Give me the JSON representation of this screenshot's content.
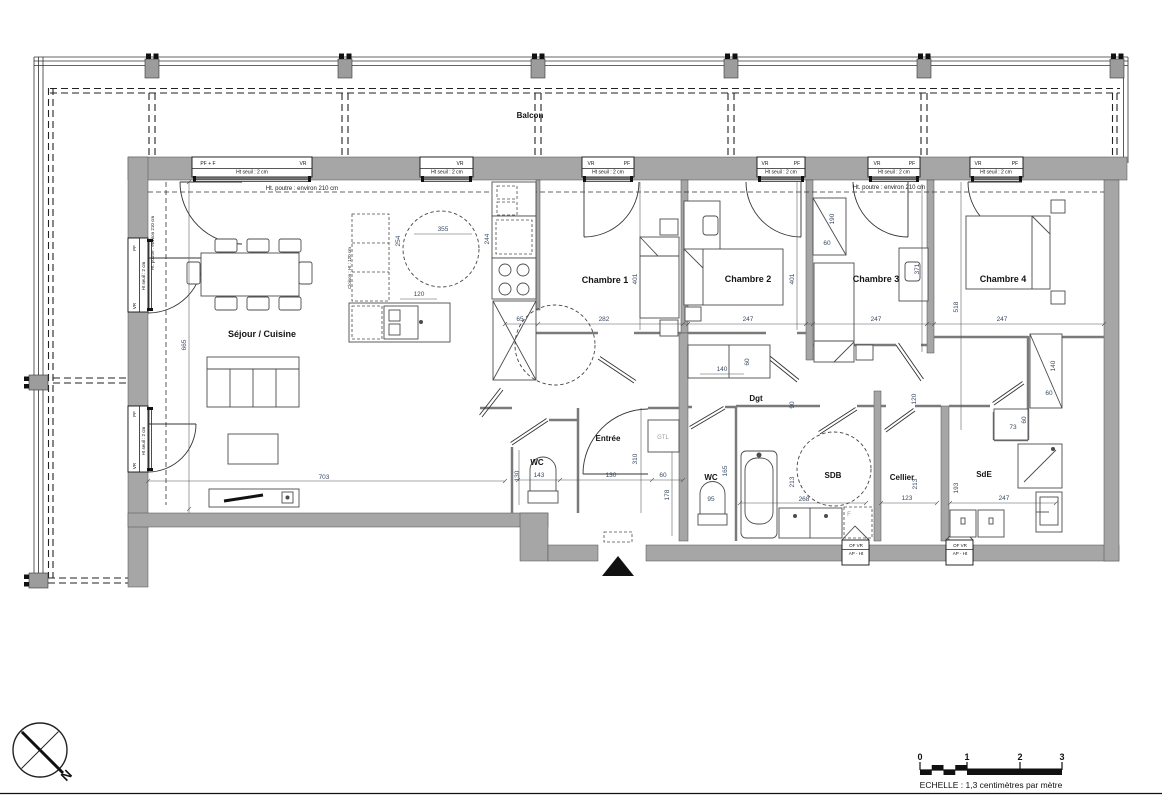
{
  "drawing": {
    "kind": "apartment floor plan",
    "compass": {
      "label": "N"
    },
    "scalebar": {
      "caption": "ECHELLE : 1,3 centimètres par mètre",
      "ticks": [
        {
          "t": "0",
          "x": 920,
          "y": 760
        },
        {
          "t": "1",
          "x": 967,
          "y": 760
        },
        {
          "t": "2",
          "x": 1020,
          "y": 760
        },
        {
          "t": "3",
          "x": 1062,
          "y": 760
        }
      ]
    }
  },
  "rooms": [
    {
      "t": "Séjour / Cuisine",
      "x": 262,
      "y": 337
    },
    {
      "t": "Chambre 1",
      "x": 605,
      "y": 283
    },
    {
      "t": "Chambre 2",
      "x": 748,
      "y": 282
    },
    {
      "t": "Chambre 3",
      "x": 876,
      "y": 282
    },
    {
      "t": "Chambre 4",
      "x": 1003,
      "y": 282
    },
    {
      "t": "Dgt",
      "x": 756,
      "y": 401,
      "c": "balcon"
    },
    {
      "t": "Entrée",
      "x": 608,
      "y": 441,
      "c": "balcon"
    },
    {
      "t": "WC",
      "x": 537,
      "y": 465,
      "c": "balcon"
    },
    {
      "t": "WC",
      "x": 711,
      "y": 480,
      "c": "balcon"
    },
    {
      "t": "SDB",
      "x": 833,
      "y": 478,
      "c": "balcon"
    },
    {
      "t": "Cellier",
      "x": 902,
      "y": 480,
      "c": "balcon"
    },
    {
      "t": "SdE",
      "x": 984,
      "y": 477,
      "c": "balcon"
    },
    {
      "t": "Balcon",
      "x": 530,
      "y": 118,
      "c": "balcon"
    }
  ],
  "annotations": [
    {
      "t": "Ht. poutre : environ 210 cm",
      "x": 302,
      "y": 190
    },
    {
      "t": "Ht. poutre : environ 210 cm",
      "x": 889,
      "y": 189
    },
    {
      "t": "Ht. poutre : environ 210 cm",
      "x": 154,
      "y": 243,
      "r": -90,
      "c": "tiny"
    },
    {
      "t": "Cloison : Ht : 120 cm",
      "x": 351,
      "y": 268,
      "r": -90,
      "c": "tiny"
    },
    {
      "t": "GTL",
      "x": 663,
      "y": 439,
      "c": "muted"
    },
    {
      "t": "F",
      "x": 849,
      "y": 516,
      "c": "muted"
    }
  ],
  "window_labels": [
    {
      "t": "PF + F",
      "x": 208,
      "y": 165
    },
    {
      "t": "VR",
      "x": 303,
      "y": 165
    },
    {
      "t": "Ht seuil : 2 cm",
      "x": 252,
      "y": 173.5
    },
    {
      "t": "VR",
      "x": 460,
      "y": 165
    },
    {
      "t": "Ht seuil : 2 cm",
      "x": 447,
      "y": 173.5
    },
    {
      "t": "VR",
      "x": 591,
      "y": 165
    },
    {
      "t": "PF",
      "x": 627,
      "y": 165
    },
    {
      "t": "Ht seuil : 2 cm",
      "x": 608,
      "y": 173.5
    },
    {
      "t": "VR",
      "x": 765,
      "y": 165
    },
    {
      "t": "PF",
      "x": 797,
      "y": 165
    },
    {
      "t": "Ht seuil : 2 cm",
      "x": 781,
      "y": 173.5
    },
    {
      "t": "VR",
      "x": 877,
      "y": 165
    },
    {
      "t": "PF",
      "x": 912,
      "y": 165
    },
    {
      "t": "Ht seuil : 2 cm",
      "x": 894,
      "y": 173.5
    },
    {
      "t": "VR",
      "x": 978,
      "y": 165
    },
    {
      "t": "PF",
      "x": 1015,
      "y": 165
    },
    {
      "t": "Ht seuil : 2 cm",
      "x": 996,
      "y": 173.5
    },
    {
      "t": "PF",
      "x": 136,
      "y": 248,
      "r": -90,
      "c": "tiny"
    },
    {
      "t": "Ht seuil : 2 cm",
      "x": 145,
      "y": 276,
      "r": -90,
      "c": "tiny"
    },
    {
      "t": "VR",
      "x": 136,
      "y": 306,
      "r": -90,
      "c": "tiny"
    },
    {
      "t": "PF",
      "x": 136,
      "y": 414,
      "r": -90,
      "c": "tiny"
    },
    {
      "t": "Ht seuil : 2 cm",
      "x": 145,
      "y": 441,
      "r": -90,
      "c": "tiny"
    },
    {
      "t": "VR",
      "x": 136,
      "y": 466,
      "r": -90,
      "c": "tiny"
    },
    {
      "t": "OF  VR",
      "x": 856,
      "y": 547,
      "c": "tiny"
    },
    {
      "t": "AP - Ht",
      "x": 856,
      "y": 555,
      "c": "tiny"
    },
    {
      "t": "OF  VR",
      "x": 960,
      "y": 547,
      "c": "tiny"
    },
    {
      "t": "AP - Ht",
      "x": 960,
      "y": 555,
      "c": "tiny"
    }
  ],
  "dimensions": [
    {
      "t": "665",
      "x": 186,
      "y": 345,
      "r": -90
    },
    {
      "t": "703",
      "x": 324,
      "y": 479
    },
    {
      "t": "355",
      "x": 443,
      "y": 231
    },
    {
      "t": "254",
      "x": 400,
      "y": 241,
      "r": -90
    },
    {
      "t": "120",
      "x": 419,
      "y": 296
    },
    {
      "t": "244",
      "x": 489,
      "y": 239,
      "r": -90
    },
    {
      "t": "65",
      "x": 520,
      "y": 321
    },
    {
      "t": "282",
      "x": 604,
      "y": 321
    },
    {
      "t": "401",
      "x": 637,
      "y": 279,
      "r": -90
    },
    {
      "t": "247",
      "x": 748,
      "y": 321
    },
    {
      "t": "401",
      "x": 794,
      "y": 279,
      "r": -90
    },
    {
      "t": "190",
      "x": 834,
      "y": 219,
      "r": -90
    },
    {
      "t": "60",
      "x": 827,
      "y": 245
    },
    {
      "t": "371",
      "x": 919,
      "y": 269,
      "r": -90
    },
    {
      "t": "247",
      "x": 876,
      "y": 321
    },
    {
      "t": "518",
      "x": 958,
      "y": 307,
      "r": -90
    },
    {
      "t": "247",
      "x": 1002,
      "y": 321
    },
    {
      "t": "140",
      "x": 722,
      "y": 371
    },
    {
      "t": "60",
      "x": 749,
      "y": 362,
      "r": -90
    },
    {
      "t": "90",
      "x": 794,
      "y": 405,
      "r": -90
    },
    {
      "t": "120",
      "x": 916,
      "y": 399,
      "r": -90
    },
    {
      "t": "143",
      "x": 539,
      "y": 477
    },
    {
      "t": "130",
      "x": 611,
      "y": 477
    },
    {
      "t": "60",
      "x": 663,
      "y": 477
    },
    {
      "t": "130",
      "x": 519,
      "y": 476,
      "r": -90
    },
    {
      "t": "310",
      "x": 637,
      "y": 459,
      "r": -90
    },
    {
      "t": "178",
      "x": 669,
      "y": 495,
      "r": -90
    },
    {
      "t": "95",
      "x": 711,
      "y": 501
    },
    {
      "t": "165",
      "x": 727,
      "y": 471,
      "r": -90
    },
    {
      "t": "213",
      "x": 794,
      "y": 482,
      "r": -90
    },
    {
      "t": "268",
      "x": 804,
      "y": 501
    },
    {
      "t": "123",
      "x": 907,
      "y": 500
    },
    {
      "t": "213",
      "x": 917,
      "y": 484,
      "r": -90
    },
    {
      "t": "193",
      "x": 958,
      "y": 488,
      "r": -90
    },
    {
      "t": "247",
      "x": 1004,
      "y": 500
    },
    {
      "t": "73",
      "x": 1013,
      "y": 429
    },
    {
      "t": "60",
      "x": 1026,
      "y": 420,
      "r": -90
    },
    {
      "t": "60",
      "x": 1049,
      "y": 395
    },
    {
      "t": "140",
      "x": 1055,
      "y": 366,
      "r": -90
    }
  ]
}
